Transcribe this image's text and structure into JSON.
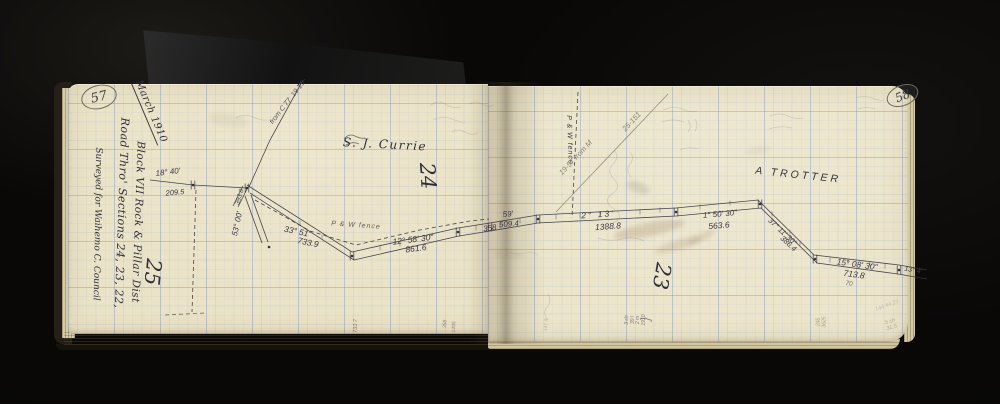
{
  "pages": {
    "left": {
      "number": "57"
    },
    "right": {
      "number": "58"
    }
  },
  "colors": {
    "ink": "#35333c",
    "pencil": "#8a8475",
    "paper": "#ebe3c7",
    "grid": "#7b9cc9"
  },
  "annotations": [
    {
      "name": "date-note",
      "text": "March 1910",
      "x": 150,
      "y": 112,
      "rot": 67,
      "size": 10,
      "cls": "hw",
      "u": true,
      "ls": 0.5
    },
    {
      "name": "title-road",
      "text": "Road Thro' Sections 24, 23, 22,",
      "x": 121,
      "y": 213,
      "rot": 92,
      "size": 11,
      "cls": "hw",
      "ls": 0.5
    },
    {
      "name": "title-block",
      "text": "Block VII Rock & Pillar Dist",
      "x": 137,
      "y": 222,
      "rot": 92,
      "size": 10.5,
      "cls": "hw",
      "ls": 0.5
    },
    {
      "name": "title-surveyed",
      "text": "Surveyed for Waihemo C. Council",
      "x": 97,
      "y": 224,
      "rot": 91,
      "size": 9,
      "cls": "hw"
    },
    {
      "name": "section-number-25",
      "text": "25",
      "x": 152,
      "y": 272,
      "rot": 96,
      "size": 21,
      "cls": "hw"
    },
    {
      "name": "owner-currie",
      "text": "S. J. Currie",
      "x": 385,
      "y": 145,
      "rot": 3,
      "size": 12,
      "cls": "hw",
      "ls": 1.5
    },
    {
      "name": "section-number-24",
      "text": "24",
      "x": 427,
      "y": 176,
      "rot": 86,
      "size": 21,
      "cls": "hw"
    },
    {
      "name": "bearing-18-40",
      "text": "18° 40'",
      "x": 168,
      "y": 173,
      "rot": -7,
      "size": 8,
      "cls": "meas"
    },
    {
      "name": "dist-209-5",
      "text": "209.5",
      "x": 175,
      "y": 193,
      "rot": -5,
      "size": 7.5,
      "cls": "meas"
    },
    {
      "name": "dist-393-8",
      "text": "393.8",
      "x": 240,
      "y": 197,
      "rot": -73,
      "size": 6.5,
      "cls": "meas"
    },
    {
      "name": "bearing-53-00",
      "text": "53° 00'",
      "x": 238,
      "y": 224,
      "rot": -78,
      "size": 8,
      "cls": "meas"
    },
    {
      "name": "bearing-33-51",
      "text": "33° 51'",
      "x": 297,
      "y": 232,
      "rot": 12,
      "size": 8.5,
      "cls": "meas"
    },
    {
      "name": "dist-733-9",
      "text": "733.9",
      "x": 308,
      "y": 243,
      "rot": 12,
      "size": 8.5,
      "cls": "meas"
    },
    {
      "name": "fence-note-left",
      "text": "P & W fence",
      "x": 356,
      "y": 226,
      "rot": 4,
      "size": 7,
      "cls": "meas",
      "op": 0.8,
      "ls": 1
    },
    {
      "name": "bearing-12-58-30",
      "text": "12° 58' 30\"",
      "x": 413,
      "y": 240,
      "rot": -7,
      "size": 8.5,
      "cls": "meas"
    },
    {
      "name": "dist-861-6",
      "text": "861.6",
      "x": 416,
      "y": 249,
      "rot": -7,
      "size": 8.5,
      "cls": "meas"
    },
    {
      "name": "dist-358",
      "text": "358",
      "x": 490,
      "y": 229,
      "rot": -8,
      "size": 8,
      "cls": "meas"
    },
    {
      "name": "ref-note-c77",
      "text": "from C 77  19-15",
      "x": 288,
      "y": 103,
      "rot": -52,
      "size": 7,
      "cls": "meas",
      "op": 0.85
    },
    {
      "name": "margin-num-733-7",
      "text": "733 7",
      "x": 356,
      "y": 326,
      "rot": -88,
      "size": 5.5,
      "cls": "meas",
      "op": 0.6
    },
    {
      "name": "margin-num-358",
      "text": "358",
      "x": 446,
      "y": 324,
      "rot": -88,
      "size": 5,
      "cls": "meas",
      "op": 0.55
    },
    {
      "name": "margin-num-1495",
      "text": "1495",
      "x": 455,
      "y": 327,
      "rot": -88,
      "size": 5,
      "cls": "meas",
      "op": 0.5
    },
    {
      "name": "dist-59",
      "text": "59'",
      "x": 508,
      "y": 215,
      "rot": -5,
      "size": 8,
      "cls": "meas"
    },
    {
      "name": "dist-509-4",
      "text": "509.4",
      "x": 509,
      "y": 225,
      "rot": -5,
      "size": 8,
      "cls": "meas"
    },
    {
      "name": "bearing-2-13",
      "text": "2° 13'",
      "x": 598,
      "y": 215,
      "rot": -4,
      "size": 8.5,
      "cls": "meas",
      "ls": 2
    },
    {
      "name": "dist-1388-8",
      "text": "1388.8",
      "x": 608,
      "y": 227,
      "rot": -4,
      "size": 8.5,
      "cls": "meas"
    },
    {
      "name": "bearing-1-50-30",
      "text": "1° 50' 30\"",
      "x": 720,
      "y": 215,
      "rot": -5,
      "size": 8,
      "cls": "meas"
    },
    {
      "name": "dist-563-6",
      "text": "563.6",
      "x": 719,
      "y": 226,
      "rot": -5,
      "size": 8.5,
      "cls": "meas"
    },
    {
      "name": "bearing-37-11-30",
      "text": "37° 11' 30\"",
      "x": 782,
      "y": 232,
      "rot": 43,
      "size": 7.5,
      "cls": "meas"
    },
    {
      "name": "dist-386-4",
      "text": "386.4",
      "x": 788,
      "y": 244,
      "rot": 43,
      "size": 7.5,
      "cls": "meas"
    },
    {
      "name": "bearing-15-08-30",
      "text": "15° 08' 30\"",
      "x": 857,
      "y": 265,
      "rot": 8,
      "size": 8.5,
      "cls": "meas"
    },
    {
      "name": "dist-713-8",
      "text": "713.8",
      "x": 854,
      "y": 275,
      "rot": 8,
      "size": 8.5,
      "cls": "meas"
    },
    {
      "name": "dist-70",
      "text": "70",
      "x": 849,
      "y": 284,
      "rot": 8,
      "size": 6.5,
      "cls": "meas",
      "op": 0.7
    },
    {
      "name": "bearing-13-4",
      "text": "13° 4'",
      "x": 913,
      "y": 271,
      "rot": 10,
      "size": 7,
      "cls": "meas"
    },
    {
      "name": "owner-trotter",
      "text": "A TROTTER",
      "x": 798,
      "y": 176,
      "rot": 6,
      "size": 10.5,
      "cls": "hwcaps",
      "ls": 3
    },
    {
      "name": "section-number-23",
      "text": "23",
      "x": 661,
      "y": 276,
      "rot": 100,
      "size": 21,
      "cls": "hw"
    },
    {
      "name": "fence-note-right",
      "text": "P & W fence",
      "x": 569,
      "y": 140,
      "rot": 88,
      "size": 7,
      "cls": "meas",
      "ls": 1
    },
    {
      "name": "ref-note-19-57",
      "text": "19-57 from M",
      "x": 576,
      "y": 158,
      "rot": -47,
      "size": 7.5,
      "cls": "pencil"
    },
    {
      "name": "ref-note-25-151",
      "text": "25-151",
      "x": 632,
      "y": 122,
      "rot": -47,
      "size": 7.5,
      "cls": "pencil"
    },
    {
      "name": "margin-note-chains",
      "lines": [
        "3 ch",
        "39 l",
        "2 m",
        "1910"
      ],
      "x": 636,
      "y": 320,
      "rot": -90,
      "size": 5,
      "cls": "meas",
      "op": 0.6
    },
    {
      "name": "margin-note-brace",
      "text": "}",
      "x": 646,
      "y": 319,
      "rot": -90,
      "size": 13,
      "cls": "meas",
      "op": 0.5
    },
    {
      "name": "margin-num-141-8",
      "text": "141 8",
      "x": 547,
      "y": 325,
      "rot": -88,
      "size": 5,
      "cls": "pencil",
      "op": 0.5
    },
    {
      "name": "margin-num-246-3625",
      "lines": [
        "246",
        "3625"
      ],
      "x": 822,
      "y": 322,
      "rot": -90,
      "size": 5,
      "cls": "pencil",
      "op": 0.7
    },
    {
      "name": "corner-note-5ch",
      "lines": [
        "5 ch",
        "31.5"
      ],
      "x": 891,
      "y": 325,
      "rot": -15,
      "size": 5.5,
      "cls": "pencil",
      "op": 0.55
    },
    {
      "name": "corner-note-144",
      "text": "144 44 23",
      "x": 887,
      "y": 306,
      "rot": -20,
      "size": 5.5,
      "cls": "pencil",
      "op": 0.4
    }
  ],
  "sketch": {
    "lines": [
      {
        "name": "traverse-upper",
        "pts": [
          [
            247,
            185
          ],
          [
            352,
            252
          ],
          [
            458,
            228
          ],
          [
            490,
            223
          ],
          [
            538,
            215
          ],
          [
            676,
            208
          ],
          [
            758,
            200
          ],
          [
            814,
            255
          ],
          [
            899,
            265
          ],
          [
            927,
            270
          ]
        ]
      },
      {
        "name": "traverse-lower",
        "pts": [
          [
            250,
            193
          ],
          [
            354,
            260
          ],
          [
            459,
            236
          ],
          [
            490,
            231
          ],
          [
            538,
            223
          ],
          [
            676,
            216
          ],
          [
            761,
            208
          ],
          [
            817,
            263
          ],
          [
            898,
            274
          ],
          [
            927,
            279
          ]
        ]
      },
      {
        "name": "approach-line",
        "pts": [
          [
            150,
            180
          ],
          [
            193,
            185
          ],
          [
            247,
            188
          ]
        ]
      },
      {
        "name": "diagonal-ref-line",
        "pts": [
          [
            249,
            187
          ],
          [
            270,
            140
          ],
          [
            303,
            80
          ]
        ]
      },
      {
        "name": "spur-line-a",
        "pts": [
          [
            245,
            196
          ],
          [
            262,
            243
          ]
        ]
      },
      {
        "name": "spur-line-b",
        "pts": [
          [
            251,
            195
          ],
          [
            268,
            242
          ]
        ]
      },
      {
        "name": "wedge-line-a",
        "pts": [
          [
            243,
            186
          ],
          [
            233,
            206
          ]
        ]
      },
      {
        "name": "wedge-line-b",
        "pts": [
          [
            248,
            187
          ],
          [
            238,
            207
          ]
        ]
      },
      {
        "name": "fence-dashed-left",
        "pts": [
          [
            255,
            200
          ],
          [
            310,
            231
          ],
          [
            356,
            245
          ],
          [
            420,
            230
          ],
          [
            470,
            221
          ],
          [
            489,
            219
          ]
        ],
        "dashed": true
      },
      {
        "name": "fence-dashed-right",
        "pts": [
          [
            578,
            92
          ],
          [
            572,
            218
          ]
        ],
        "dashed": true
      },
      {
        "name": "dashed-vertical-left",
        "pts": [
          [
            196,
            190
          ],
          [
            192,
            312
          ]
        ],
        "dashed": true
      },
      {
        "name": "dashed-bottom-left",
        "pts": [
          [
            165,
            315
          ],
          [
            205,
            313
          ]
        ],
        "dashed": true,
        "op": 0.7
      },
      {
        "name": "pencil-diagonal",
        "pts": [
          [
            556,
            212
          ],
          [
            668,
            94
          ]
        ],
        "pencil": true
      },
      {
        "name": "diagonal-end-tick",
        "pts": [
          [
            297,
            86
          ],
          [
            305,
            79
          ]
        ]
      }
    ],
    "stations": [
      [
        193,
        185
      ],
      [
        247,
        188
      ],
      [
        352,
        256
      ],
      [
        458,
        232
      ],
      [
        490,
        227
      ],
      [
        538,
        219
      ],
      [
        676,
        212
      ],
      [
        760,
        204
      ],
      [
        815,
        259
      ],
      [
        899,
        270
      ]
    ],
    "ticks": [
      [
        300,
        223
      ],
      [
        322,
        237
      ],
      [
        380,
        248
      ],
      [
        400,
        244
      ],
      [
        430,
        236
      ],
      [
        476,
        228
      ],
      [
        500,
        226
      ],
      [
        520,
        221
      ],
      [
        556,
        217
      ],
      [
        580,
        216
      ],
      [
        600,
        214
      ],
      [
        640,
        212
      ],
      [
        660,
        210
      ],
      [
        700,
        207
      ],
      [
        730,
        203
      ],
      [
        772,
        214
      ],
      [
        790,
        232
      ],
      [
        800,
        243
      ],
      [
        830,
        260
      ],
      [
        848,
        262
      ],
      [
        870,
        264
      ],
      [
        885,
        266
      ]
    ],
    "dots": [
      [
        193,
        185
      ],
      [
        247,
        188
      ],
      [
        352,
        256
      ],
      [
        458,
        232
      ],
      [
        538,
        219
      ],
      [
        676,
        212
      ],
      [
        760,
        204
      ],
      [
        815,
        259
      ],
      [
        899,
        270
      ],
      [
        269,
        247
      ]
    ],
    "scribbles": [
      {
        "d": "M430,106 q7,-7 15,-2 t15,3 m-27,13 q9,-5 19,-1 t13,3"
      },
      {
        "d": "M452,132 q6,-4 13,0 t13,1"
      },
      {
        "d": "M614,150 q6,7 -1,14 t1,15 t-2,15 t2,15 t-1,14"
      },
      {
        "d": "M630,152 q5,6 0,12 t1,13"
      },
      {
        "d": "M664,110 q9,-5 18,-1 t15,2 m-35,11 q11,-4 22,0"
      },
      {
        "d": "M770,116 q9,-4 18,0 t15,2 m-34,11 q12,-4 23,-1"
      },
      {
        "d": "M856,98 q8,-3 16,0 t12,2 m-26,9 q9,-3 17,0"
      },
      {
        "d": "M548,294 q4,7 -1,13 t1,13"
      },
      {
        "d": "M344,139 q5,-6 11,-3 t10,2 m-19,7 q7,-4 13,-1",
        "ink": true,
        "op": 0.7
      },
      {
        "d": "M688,120 q4,6 0,12 m7,-13 q4,6 0,12 m-15,19 q9,-4 18,-1"
      },
      {
        "d": "M598,238 q12,4 24,1 t22,2"
      },
      {
        "d": "M236,118 q8,-5 17,-1 t14,3"
      },
      {
        "d": "M470,104 q6,-4 12,0 t12,1"
      },
      {
        "d": "M508,252 q8,3 16,1 t14,2",
        "op": 0.2
      }
    ]
  },
  "stains": [
    {
      "x": 649,
      "y": 229,
      "w": 72,
      "h": 13,
      "rot": -11,
      "color": "rgba(128,96,58,0.20)"
    },
    {
      "x": 678,
      "y": 245,
      "w": 48,
      "h": 10,
      "rot": -17,
      "color": "rgba(128,96,58,0.16)"
    },
    {
      "x": 702,
      "y": 237,
      "w": 30,
      "h": 8,
      "rot": -28,
      "color": "rgba(128,96,58,0.14)"
    },
    {
      "x": 638,
      "y": 187,
      "w": 24,
      "h": 11,
      "rot": 22,
      "color": "rgba(120,112,92,0.18)"
    },
    {
      "x": 228,
      "y": 120,
      "w": 40,
      "h": 14,
      "rot": 8,
      "color": "rgba(150,138,108,0.10)"
    },
    {
      "x": 758,
      "y": 150,
      "w": 26,
      "h": 9,
      "rot": -10,
      "color": "rgba(150,138,108,0.10)"
    },
    {
      "x": 508,
      "y": 254,
      "w": 30,
      "h": 10,
      "rot": 6,
      "color": "rgba(140,125,95,0.12)"
    }
  ]
}
